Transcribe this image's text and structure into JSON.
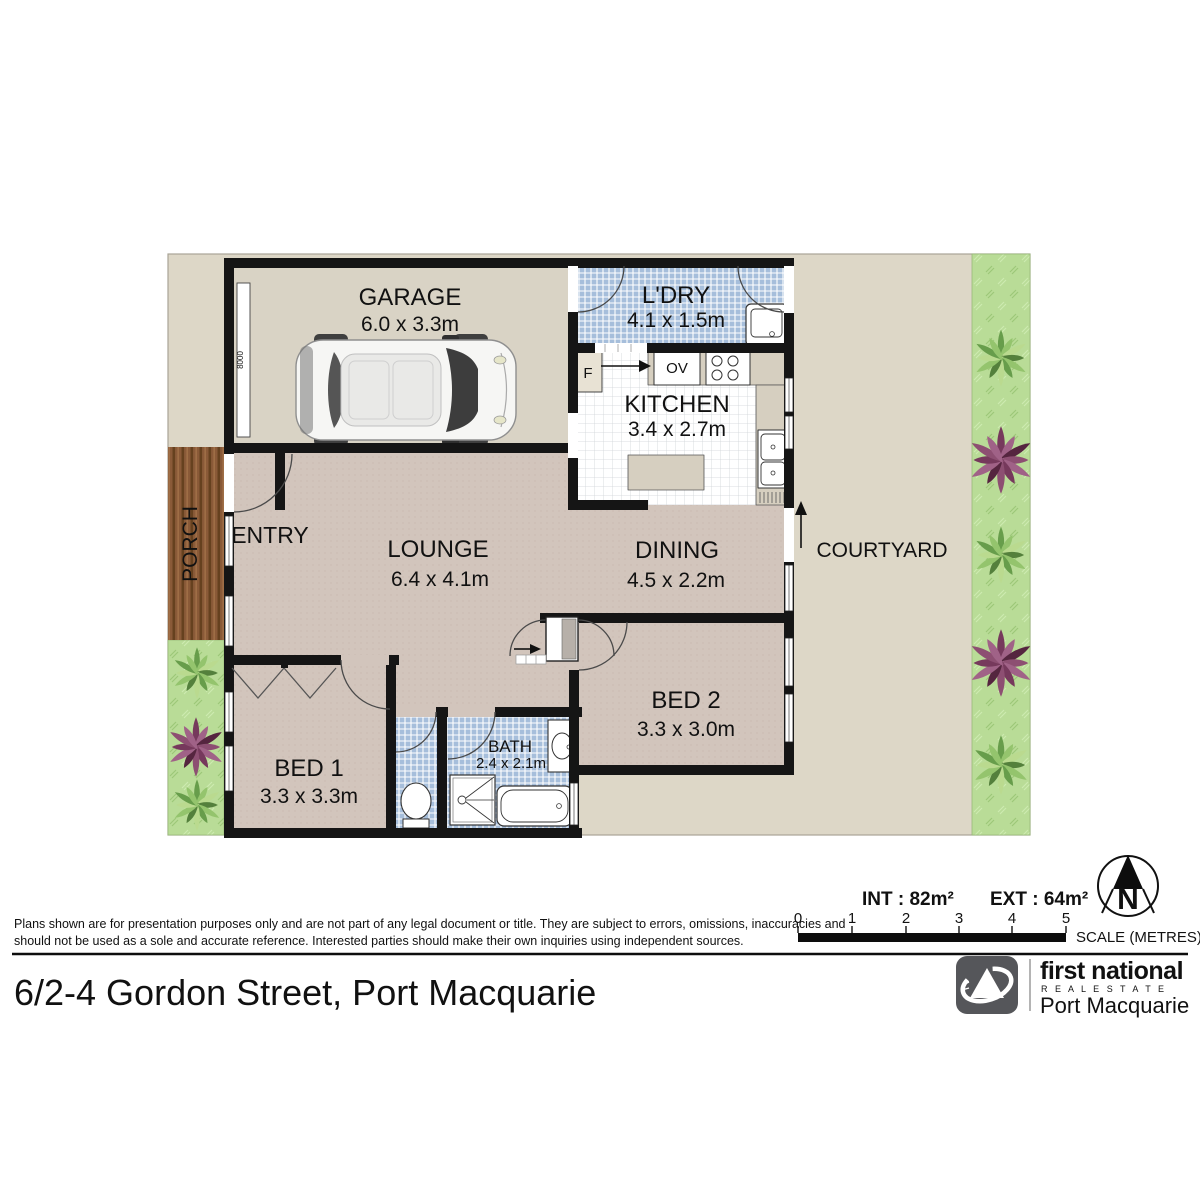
{
  "plan": {
    "rooms": {
      "garage": {
        "name": "GARAGE",
        "dims": "6.0 x 3.3m"
      },
      "laundry": {
        "name": "L'DRY",
        "dims": "4.1 x 1.5m"
      },
      "kitchen": {
        "name": "KITCHEN",
        "dims": "3.4 x 2.7m"
      },
      "entry": {
        "name": "ENTRY"
      },
      "lounge": {
        "name": "LOUNGE",
        "dims": "6.4 x 4.1m"
      },
      "dining": {
        "name": "DINING",
        "dims": "4.5 x 2.2m"
      },
      "courtyard": {
        "name": "COURTYARD"
      },
      "porch": {
        "name": "PORCH"
      },
      "bed1": {
        "name": "BED 1",
        "dims": "3.3 x 3.3m"
      },
      "bed2": {
        "name": "BED 2",
        "dims": "3.3 x 3.0m"
      },
      "bath": {
        "name": "BATH",
        "dims": "2.4 x 2.1m"
      }
    },
    "appliances": {
      "fridge": "F",
      "oven": "OV"
    },
    "garage_door_label": "8000"
  },
  "footer": {
    "disclaimer_line1": "Plans shown are for presentation purposes only and are not part of any legal document or title. They are subject to errors, omissions, inaccuracies and",
    "disclaimer_line2": "should not be used as a sole and accurate reference. Interested parties should make their own inquiries using independent sources.",
    "areas": {
      "internal": "INT : 82m²",
      "external": "EXT : 64m²"
    },
    "scale": {
      "ticks": [
        "0",
        "1",
        "2",
        "3",
        "4",
        "5"
      ],
      "label": "SCALE (METRES)"
    },
    "compass": {
      "label": "N"
    },
    "address": "6/2-4 Gordon Street, Port Macquarie",
    "logo": {
      "line1": "first national",
      "line2": "R E A L   E S T A T E",
      "line3": "Port Macquarie"
    }
  },
  "colors": {
    "wall": "#151515",
    "exterior": "#ddd7c7",
    "garage_floor": "#d9d3c5",
    "living_floor": "#d2c5bc",
    "wet_area": "#a6bedb",
    "grass": "#b9dc97",
    "porch_wood": "#8a5a38",
    "benchtop": "#d6cfc0",
    "logo_grey": "#55565a"
  }
}
